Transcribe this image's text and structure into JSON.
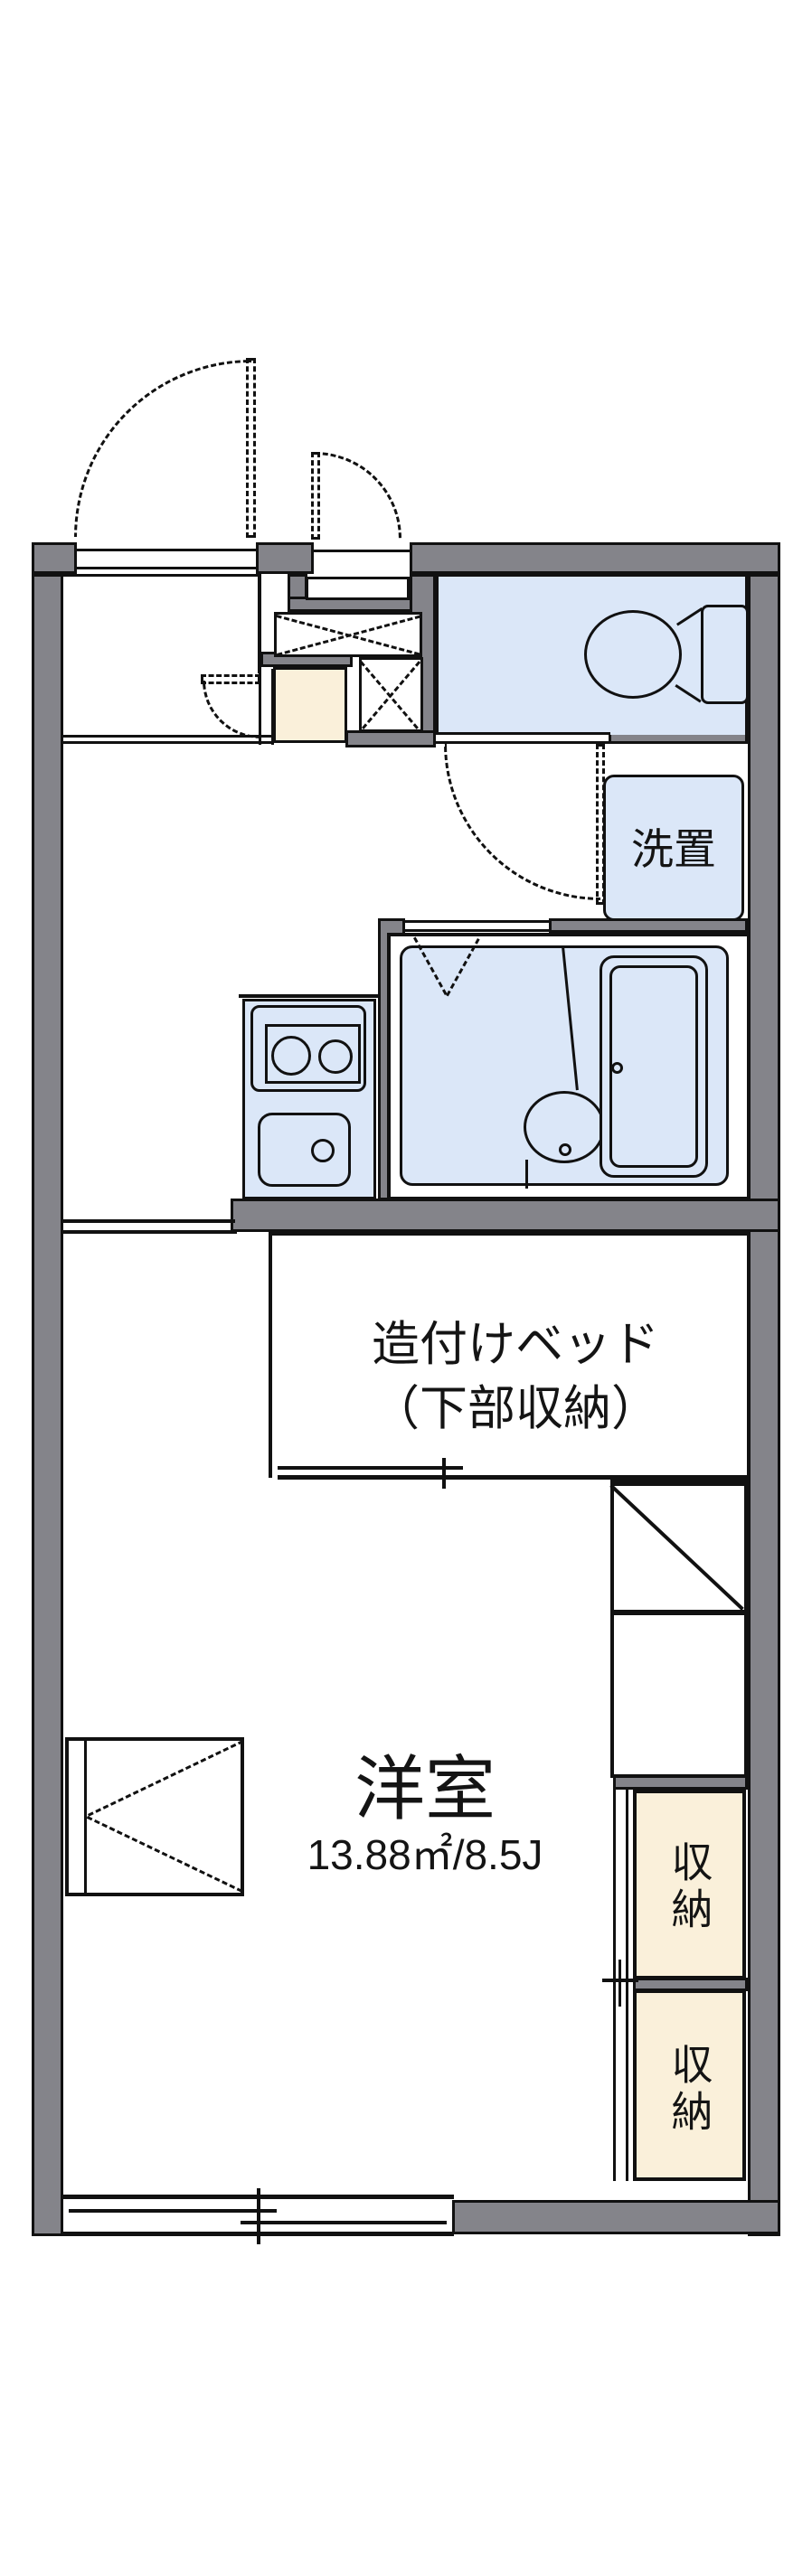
{
  "labels": {
    "room_name": "洋室",
    "room_size": "13.88㎡/8.5J",
    "bed_line1": "造付けベッド",
    "bed_line2": "（下部収納）",
    "laundry": "洗置",
    "storage_top": "収納",
    "storage_bottom": "収納"
  },
  "colors": {
    "wall": "#84848a",
    "wet_area_fill": "#dbe7f8",
    "entry_tile_fill": "#faf0da",
    "outline": "#111111",
    "background": "#ffffff"
  }
}
